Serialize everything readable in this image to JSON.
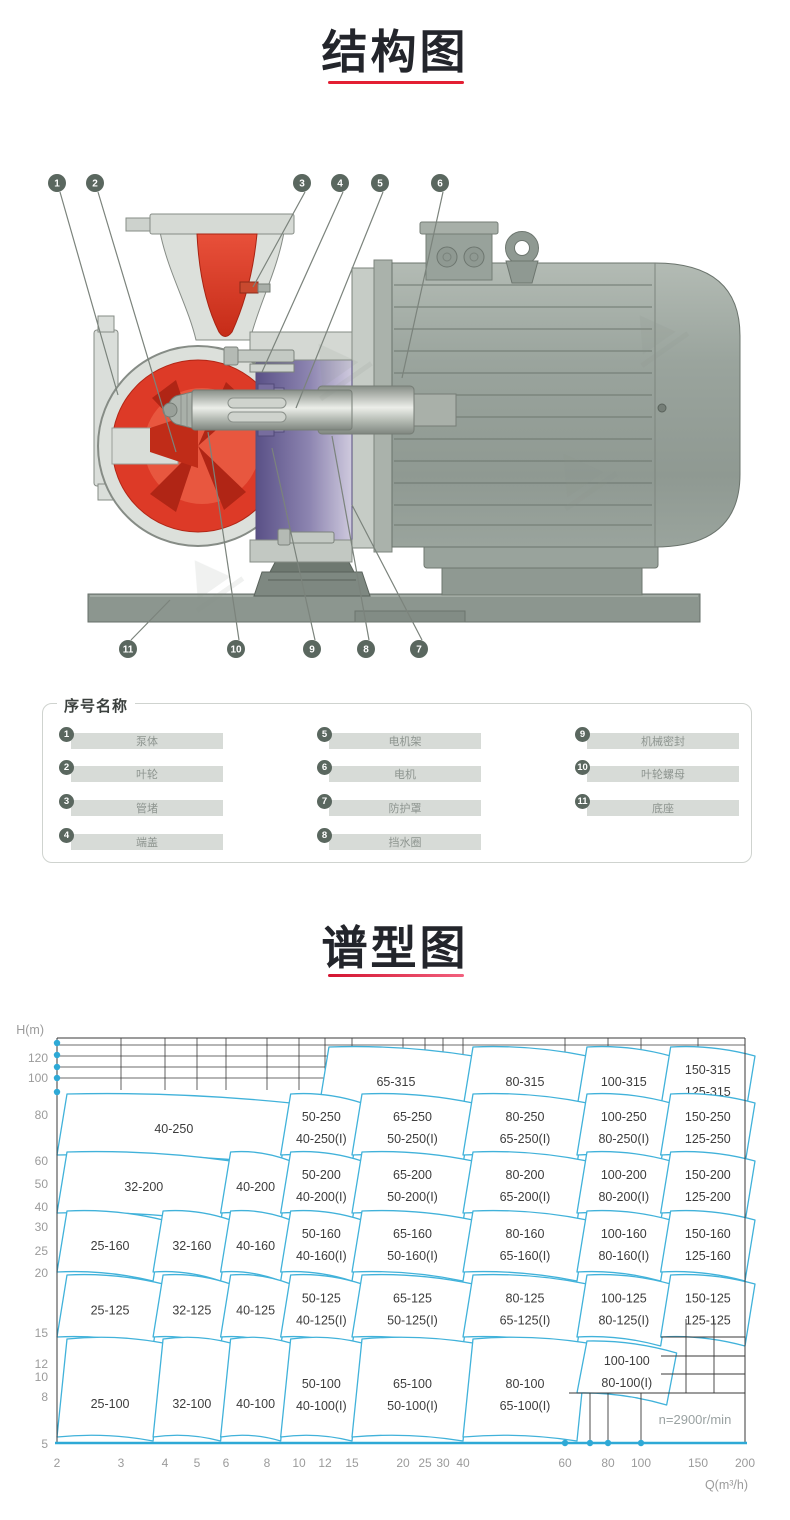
{
  "sections": {
    "structure_title": "结构图",
    "spectrum_title": "谱型图"
  },
  "colors": {
    "accent_red": "#e31f33",
    "chart_region_stroke": "#41b2da",
    "chart_axis_cyan": "#2ea9d6",
    "callout_badge": "#5a675f",
    "pump_red": "#dd3a27",
    "bracket_purple": "#6f6596",
    "motor_gray": "#99a39c"
  },
  "structure_diagram": {
    "callouts_top": [
      "1",
      "2",
      "3",
      "4",
      "5",
      "6"
    ],
    "callouts_bottom": [
      "11",
      "10",
      "9",
      "8",
      "7"
    ]
  },
  "parts_legend": {
    "title": "序号名称",
    "items": [
      {
        "num": "1",
        "name": "泵体"
      },
      {
        "num": "2",
        "name": "叶轮"
      },
      {
        "num": "3",
        "name": "管堵"
      },
      {
        "num": "4",
        "name": "端盖"
      },
      {
        "num": "5",
        "name": "电机架"
      },
      {
        "num": "6",
        "name": "电机"
      },
      {
        "num": "7",
        "name": "防护罩"
      },
      {
        "num": "8",
        "name": "挡水圈"
      },
      {
        "num": "9",
        "name": "机械密封"
      },
      {
        "num": "10",
        "name": "叶轮螺母"
      },
      {
        "num": "11",
        "name": "底座"
      }
    ]
  },
  "chart_data": {
    "type": "area",
    "subtype": "pump-selection-region-map",
    "title": "谱型图",
    "xlabel": "Q(m³/h)",
    "ylabel": "H(m)",
    "x_scale": "log",
    "y_scale": "log",
    "xlim": [
      2,
      200
    ],
    "ylim": [
      5,
      140
    ],
    "x_ticks": [
      2,
      3,
      4,
      5,
      6,
      8,
      10,
      12,
      15,
      20,
      25,
      30,
      40,
      60,
      80,
      100,
      150,
      200
    ],
    "y_ticks": [
      120,
      100,
      80,
      60,
      50,
      40,
      30,
      25,
      20,
      15,
      12,
      10,
      8,
      5
    ],
    "annotation": "n=2900r/min",
    "legend_position": "none",
    "grid": true,
    "rows": [
      {
        "head": "315",
        "cells": [
          {
            "labels": [
              "65-315"
            ],
            "q": [
              11.5,
              40
            ]
          },
          {
            "labels": [
              "80-315"
            ],
            "q": [
              40,
              65
            ]
          },
          {
            "labels": [
              "100-315"
            ],
            "q": [
              65,
              115
            ]
          },
          {
            "labels": [
              "150-315",
              "125-315"
            ],
            "q": [
              115,
              200
            ]
          }
        ]
      },
      {
        "head": "250",
        "cells": [
          {
            "labels": [
              "40-250"
            ],
            "q": [
              2,
              8.8
            ]
          },
          {
            "labels": [
              "50-250",
              "40-250(I)"
            ],
            "q": [
              8.8,
              15
            ]
          },
          {
            "labels": [
              "65-250",
              "50-250(I)"
            ],
            "q": [
              15,
              40
            ]
          },
          {
            "labels": [
              "80-250",
              "65-250(I)"
            ],
            "q": [
              40,
              65
            ]
          },
          {
            "labels": [
              "100-250",
              "80-250(I)"
            ],
            "q": [
              65,
              115
            ]
          },
          {
            "labels": [
              "150-250",
              "125-250"
            ],
            "q": [
              115,
              200
            ]
          }
        ]
      },
      {
        "head": "200",
        "cells": [
          {
            "labels": [
              "32-200"
            ],
            "q": [
              2,
              5.8
            ]
          },
          {
            "labels": [
              "40-200"
            ],
            "q": [
              5.8,
              8.8
            ]
          },
          {
            "labels": [
              "50-200",
              "40-200(I)"
            ],
            "q": [
              8.8,
              15
            ]
          },
          {
            "labels": [
              "65-200",
              "50-200(I)"
            ],
            "q": [
              15,
              40
            ]
          },
          {
            "labels": [
              "80-200",
              "65-200(I)"
            ],
            "q": [
              40,
              65
            ]
          },
          {
            "labels": [
              "100-200",
              "80-200(I)"
            ],
            "q": [
              65,
              115
            ]
          },
          {
            "labels": [
              "150-200",
              "125-200"
            ],
            "q": [
              115,
              200
            ]
          }
        ]
      },
      {
        "head": "160",
        "cells": [
          {
            "labels": [
              "25-160"
            ],
            "q": [
              2,
              3.7
            ]
          },
          {
            "labels": [
              "32-160"
            ],
            "q": [
              3.7,
              5.8
            ]
          },
          {
            "labels": [
              "40-160"
            ],
            "q": [
              5.8,
              8.8
            ]
          },
          {
            "labels": [
              "50-160",
              "40-160(I)"
            ],
            "q": [
              8.8,
              15
            ]
          },
          {
            "labels": [
              "65-160",
              "50-160(I)"
            ],
            "q": [
              15,
              40
            ]
          },
          {
            "labels": [
              "80-160",
              "65-160(I)"
            ],
            "q": [
              40,
              65
            ]
          },
          {
            "labels": [
              "100-160",
              "80-160(I)"
            ],
            "q": [
              65,
              115
            ]
          },
          {
            "labels": [
              "150-160",
              "125-160"
            ],
            "q": [
              115,
              200
            ]
          }
        ]
      },
      {
        "head": "125",
        "cells": [
          {
            "labels": [
              "25-125"
            ],
            "q": [
              2,
              3.7
            ]
          },
          {
            "labels": [
              "32-125"
            ],
            "q": [
              3.7,
              5.8
            ]
          },
          {
            "labels": [
              "40-125"
            ],
            "q": [
              5.8,
              8.8
            ]
          },
          {
            "labels": [
              "50-125",
              "40-125(I)"
            ],
            "q": [
              8.8,
              15
            ]
          },
          {
            "labels": [
              "65-125",
              "50-125(I)"
            ],
            "q": [
              15,
              40
            ]
          },
          {
            "labels": [
              "80-125",
              "65-125(I)"
            ],
            "q": [
              40,
              65
            ]
          },
          {
            "labels": [
              "100-125",
              "80-125(I)"
            ],
            "q": [
              65,
              115
            ]
          },
          {
            "labels": [
              "150-125",
              "125-125"
            ],
            "q": [
              115,
              200
            ]
          }
        ]
      },
      {
        "head": "100",
        "cells": [
          {
            "labels": [
              "25-100"
            ],
            "q": [
              2,
              3.7
            ]
          },
          {
            "labels": [
              "32-100"
            ],
            "q": [
              3.7,
              5.8
            ]
          },
          {
            "labels": [
              "40-100"
            ],
            "q": [
              5.8,
              8.8
            ]
          },
          {
            "labels": [
              "50-100",
              "40-100(I)"
            ],
            "q": [
              8.8,
              15
            ]
          },
          {
            "labels": [
              "65-100",
              "50-100(I)"
            ],
            "q": [
              15,
              40
            ]
          },
          {
            "labels": [
              "80-100",
              "65-100(I)"
            ],
            "q": [
              40,
              65
            ]
          },
          {
            "labels": [
              "100-100",
              "80-100(I)"
            ],
            "q": [
              65,
              120
            ],
            "short": true
          }
        ]
      }
    ]
  }
}
